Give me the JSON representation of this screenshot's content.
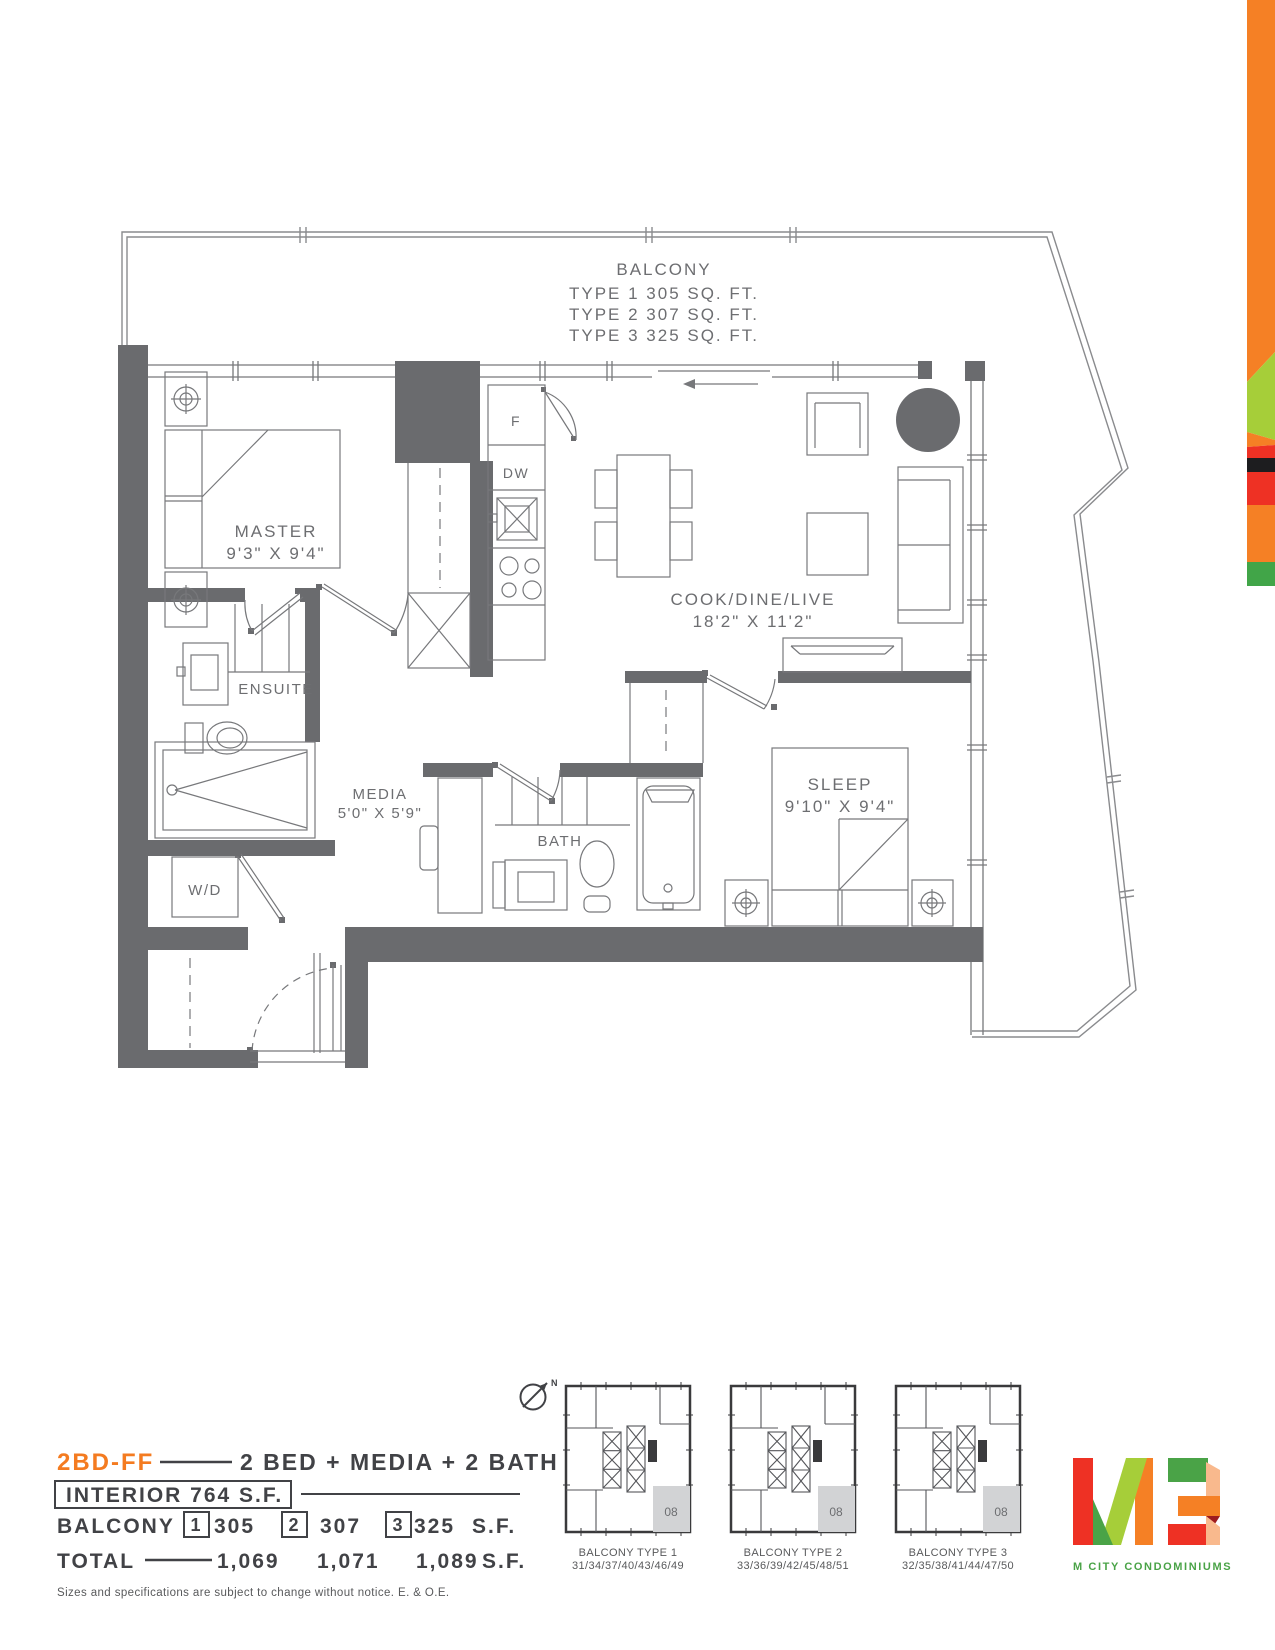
{
  "balcony_note": {
    "title": "BALCONY",
    "line1": "TYPE 1 305 SQ. FT.",
    "line2": "TYPE 2 307 SQ. FT.",
    "line3": "TYPE 3 325 SQ. FT."
  },
  "rooms": {
    "master_name": "MASTER",
    "master_dims": "9'3\" X 9'4\"",
    "ensuite_name": "ENSUITE",
    "media_name": "MEDIA",
    "media_dims": "5'0\" X 5'9\"",
    "bath_name": "BATH",
    "living_name": "COOK/DINE/LIVE",
    "living_dims": "18'2\" X 11'2\"",
    "sleep_name": "SLEEP",
    "sleep_dims": "9'10\" X 9'4\"",
    "wd_name": "W/D",
    "fridge": "F",
    "dishwasher": "DW"
  },
  "legend": {
    "unit_code": "2BD-FF",
    "unit_desc": "2 BED + MEDIA + 2 BATH",
    "interior": "INTERIOR 764 S.F.",
    "balcony_label": "BALCONY",
    "balcony_opts": [
      {
        "num": "1",
        "area": "305"
      },
      {
        "num": "2",
        "area": "307"
      },
      {
        "num": "3",
        "area": "325"
      }
    ],
    "balcony_unit": "S.F.",
    "total_label": "TOTAL",
    "totals": [
      "1,069",
      "1,071",
      "1,089"
    ],
    "total_unit": "S.F."
  },
  "keyplans": {
    "north": "N",
    "items": [
      {
        "label": "BALCONY TYPE 1",
        "units": "31/34/37/40/43/46/49",
        "unit": "08"
      },
      {
        "label": "BALCONY TYPE 2",
        "units": "33/36/39/42/45/48/51",
        "unit": "08"
      },
      {
        "label": "BALCONY TYPE 3",
        "units": "32/35/38/41/44/47/50",
        "unit": "08"
      }
    ]
  },
  "logo": {
    "tagline": "M CITY CONDOMINIUMS"
  },
  "footer": "Sizes and specifications are subject to change without notice. E. & O.E.",
  "colors": {
    "accent_orange": "#F58025",
    "light_green": "#A6CE39",
    "red": "#EE3124",
    "black_band": "#1D1D1F",
    "green": "#41A548",
    "wall_gray": "#6A6B6E",
    "line_gray": "#77787B",
    "text_gray": "#6D6E71",
    "logo_peach": "#F9B98D",
    "logo_dark_red": "#9E1B1F"
  }
}
